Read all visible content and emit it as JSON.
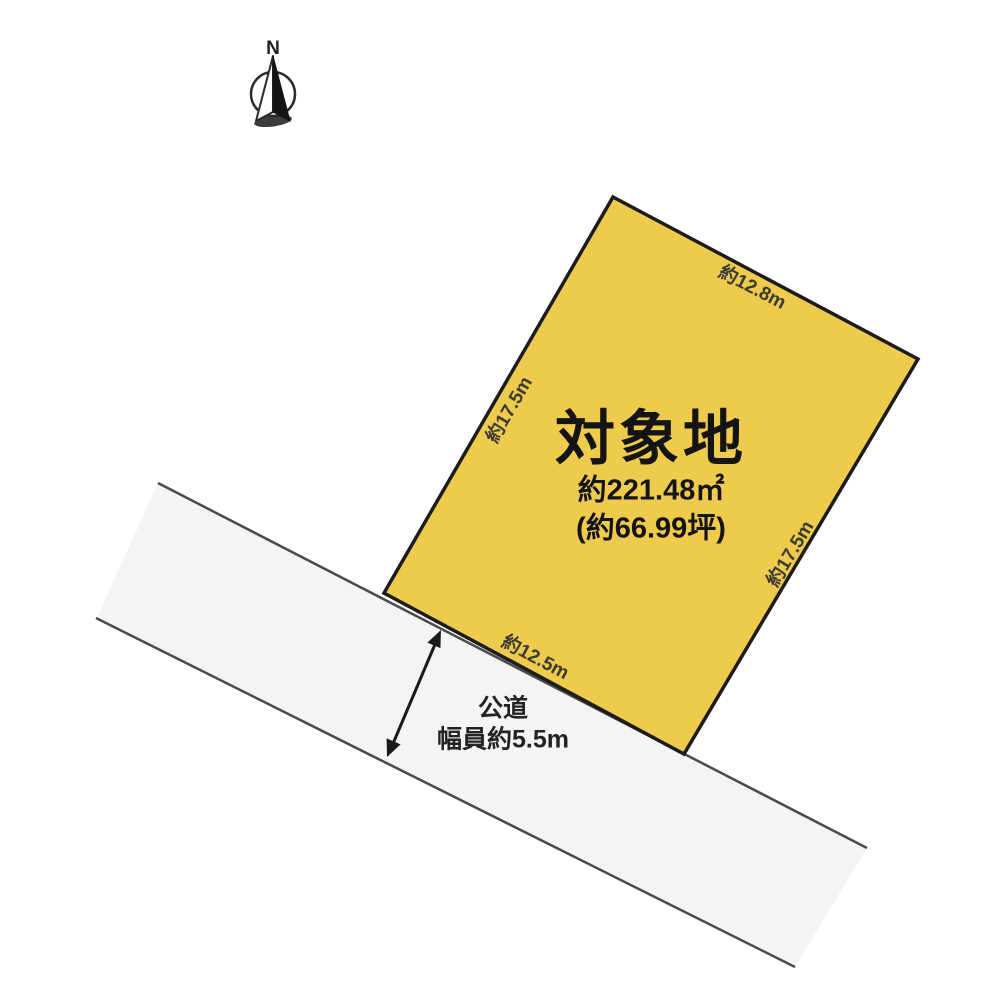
{
  "diagram": {
    "type": "land-plot-site-plan",
    "background_color": "#ffffff"
  },
  "compass": {
    "label": "N"
  },
  "lot": {
    "title": "対象地",
    "area_m2": "約221.48㎡",
    "area_tsubo": "(約66.99坪)",
    "fill_color": "#efcb4d",
    "border_color": "#1c1c1c",
    "dimensions": {
      "top": "約12.8m",
      "left": "約17.5m",
      "right": "約17.5m",
      "bottom": "約12.5m"
    }
  },
  "road": {
    "name": "公道",
    "width_label": "幅員約5.5m",
    "fill_color": "#f4f4f5",
    "line_color": "#4b4b4b",
    "arrow_color": "#1a1a1a"
  }
}
